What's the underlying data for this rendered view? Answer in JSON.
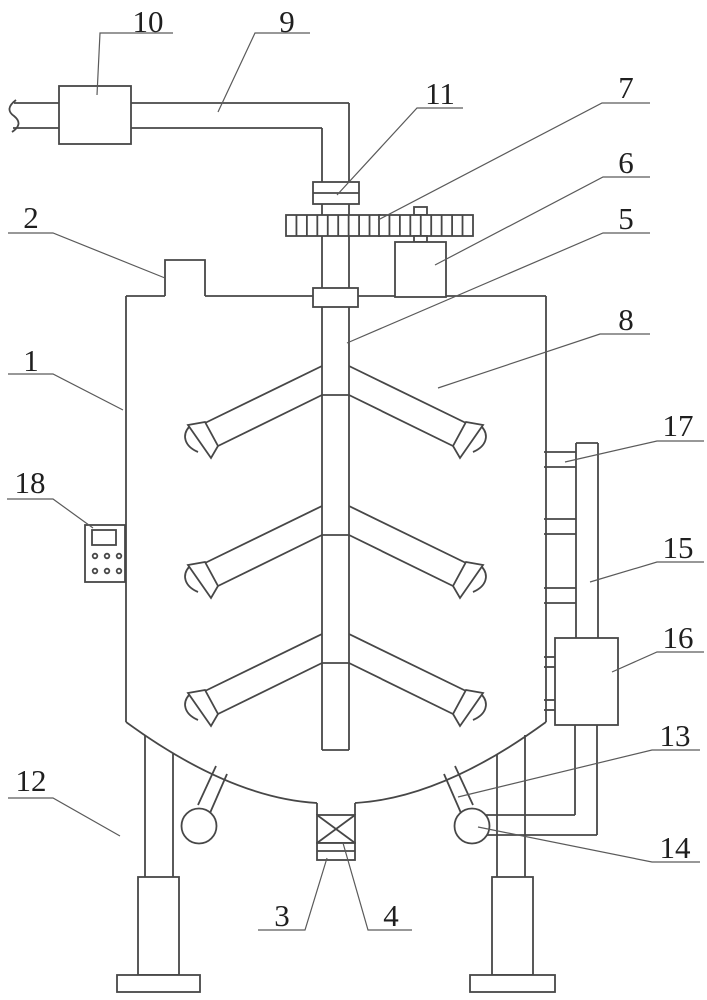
{
  "figure": {
    "kind": "patent-style-line-drawing",
    "colors": {
      "line": "#474747",
      "leader": "#5a5a5a",
      "text": "#1f1f1f",
      "background": "#ffffff"
    },
    "labels": [
      {
        "n": "1",
        "name": "tank-shell",
        "tx": 31,
        "ty": 371,
        "ul": [
          8,
          53,
          374
        ],
        "anchor": 2,
        "to": [
          123,
          410
        ]
      },
      {
        "n": "2",
        "name": "feed-port",
        "tx": 31,
        "ty": 228,
        "ul": [
          8,
          53,
          233
        ],
        "anchor": 2,
        "to": [
          165,
          278
        ]
      },
      {
        "n": "3",
        "name": "discharge-collar",
        "tx": 282,
        "ty": 926,
        "ul": [
          258,
          305,
          930
        ],
        "anchor": 2,
        "to": [
          327,
          858
        ]
      },
      {
        "n": "4",
        "name": "discharge-valve",
        "tx": 391,
        "ty": 926,
        "ul": [
          368,
          412,
          930
        ],
        "anchor": 1,
        "to": [
          343,
          843
        ]
      },
      {
        "n": "5",
        "name": "agitator-shaft",
        "tx": 626,
        "ty": 229,
        "ul": [
          603,
          650,
          233
        ],
        "anchor": 1,
        "to": [
          347,
          343
        ]
      },
      {
        "n": "6",
        "name": "drive-motor",
        "tx": 626,
        "ty": 173,
        "ul": [
          603,
          650,
          177
        ],
        "anchor": 1,
        "to": [
          435,
          265
        ]
      },
      {
        "n": "7",
        "name": "gear-mesh",
        "tx": 626,
        "ty": 98,
        "ul": [
          602,
          650,
          103
        ],
        "anchor": 1,
        "to": [
          378,
          220
        ]
      },
      {
        "n": "8",
        "name": "tank-interior",
        "tx": 626,
        "ty": 330,
        "ul": [
          600,
          650,
          334
        ],
        "anchor": 1,
        "to": [
          438,
          388
        ]
      },
      {
        "n": "9",
        "name": "feed-pipe",
        "tx": 287,
        "ty": 32,
        "ul": [
          255,
          310,
          33
        ],
        "anchor": 1,
        "to": [
          218,
          112
        ]
      },
      {
        "n": "10",
        "name": "inline-unit",
        "tx": 148,
        "ty": 32,
        "ul": [
          100,
          173,
          33
        ],
        "anchor": 1,
        "to": [
          97,
          95
        ]
      },
      {
        "n": "11",
        "name": "shaft-coupling",
        "tx": 440,
        "ty": 104,
        "ul": [
          417,
          463,
          108
        ],
        "anchor": 1,
        "to": [
          337,
          195
        ]
      },
      {
        "n": "12",
        "name": "support-leg",
        "tx": 31,
        "ty": 791,
        "ul": [
          8,
          53,
          798
        ],
        "anchor": 2,
        "to": [
          120,
          836
        ]
      },
      {
        "n": "13",
        "name": "drain-stub",
        "tx": 675,
        "ty": 746,
        "ul": [
          652,
          700,
          750
        ],
        "anchor": 1,
        "to": [
          458,
          797
        ]
      },
      {
        "n": "14",
        "name": "ball-joint",
        "tx": 675,
        "ty": 858,
        "ul": [
          652,
          700,
          862
        ],
        "anchor": 1,
        "to": [
          478,
          827
        ]
      },
      {
        "n": "15",
        "name": "riser-pipe",
        "tx": 678,
        "ty": 558,
        "ul": [
          657,
          704,
          562
        ],
        "anchor": 1,
        "to": [
          590,
          582
        ]
      },
      {
        "n": "16",
        "name": "circulation-box",
        "tx": 678,
        "ty": 648,
        "ul": [
          657,
          704,
          652
        ],
        "anchor": 1,
        "to": [
          612,
          672
        ]
      },
      {
        "n": "17",
        "name": "pipe-stub",
        "tx": 678,
        "ty": 436,
        "ul": [
          657,
          704,
          441
        ],
        "anchor": 1,
        "to": [
          565,
          462
        ]
      },
      {
        "n": "18",
        "name": "control-panel",
        "tx": 30,
        "ty": 493,
        "ul": [
          7,
          53,
          499
        ],
        "anchor": 2,
        "to": [
          93,
          528
        ]
      }
    ]
  }
}
